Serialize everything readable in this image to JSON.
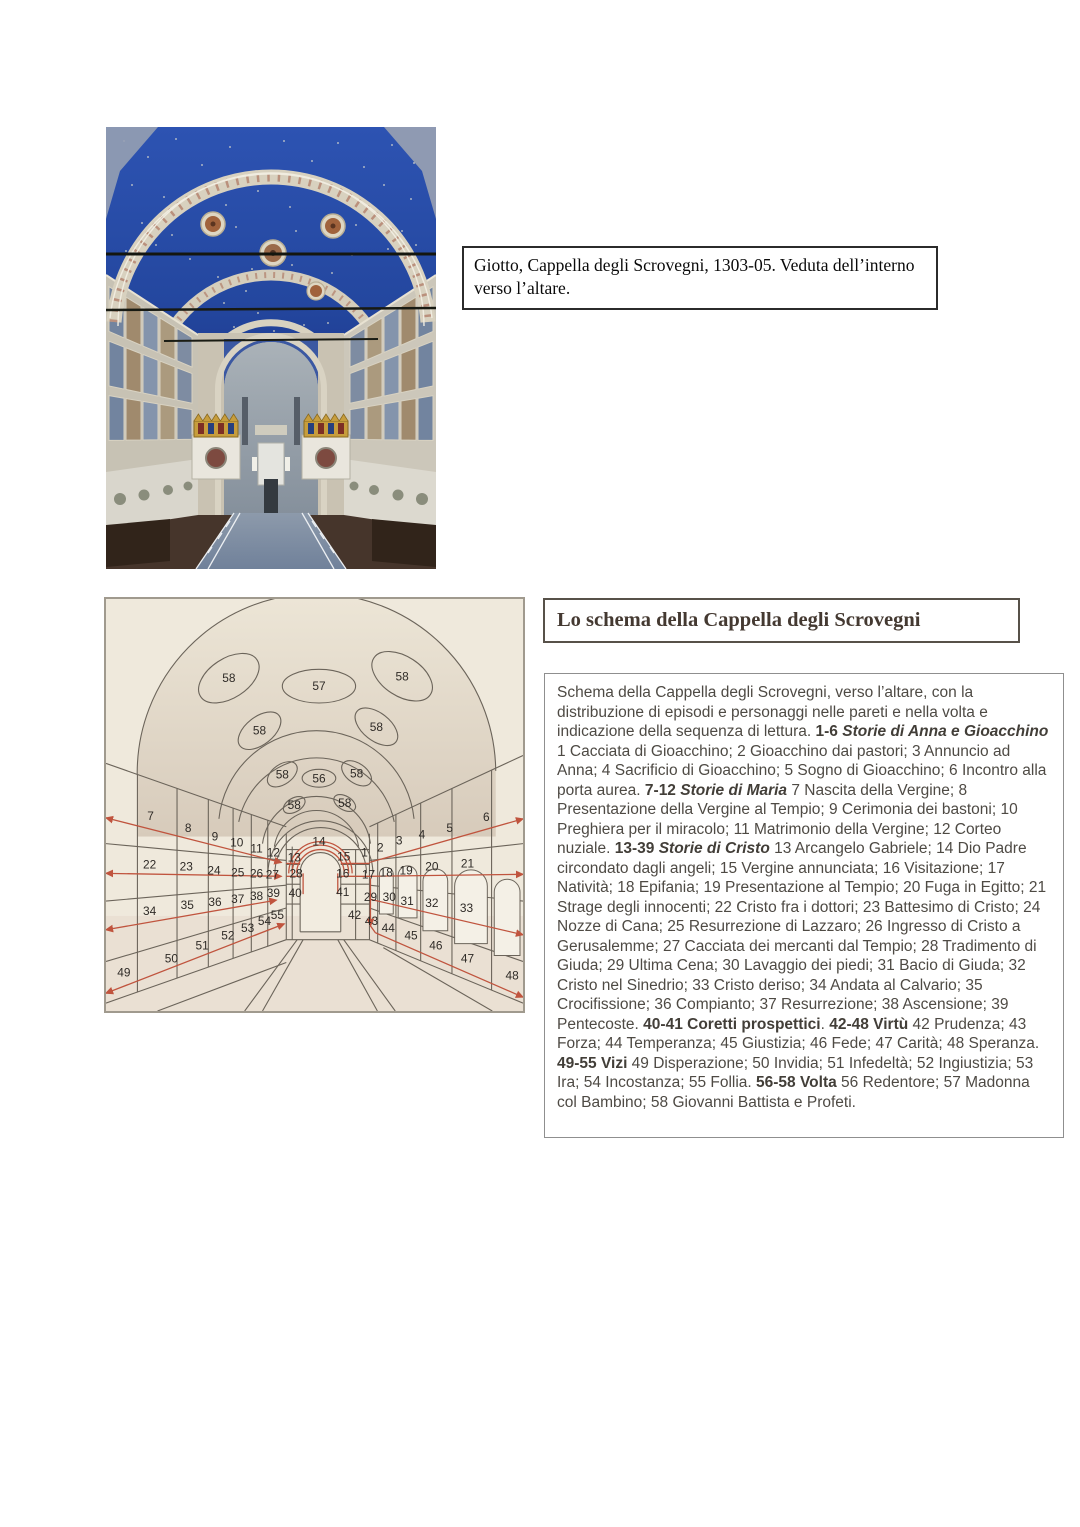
{
  "caption_box": {
    "text": "Giotto, Cappella degli Scrovegni, 1303-05. Veduta dell’interno verso l’altare."
  },
  "schema": {
    "title": "Lo schema della Cappella degli Scrovegni",
    "description": [
      {
        "t": "Schema della Cappella degli Scrovegni, verso l’altare, con la distribuzione di episodi e personaggi nelle pareti e nella volta e indicazione della sequenza di lettura. "
      },
      {
        "t": "1-6 ",
        "b": true
      },
      {
        "t": "Storie di Anna e Gioacchino",
        "b": true,
        "i": true
      },
      {
        "t": " 1 Cacciata di Gioacchino; 2 Gioacchino dai pastori; 3 Annuncio ad Anna; 4 Sacrificio di Gioacchino; 5 Sogno di Gioacchino; 6 Incontro alla porta aurea. "
      },
      {
        "t": "7-12 ",
        "b": true
      },
      {
        "t": "Storie di Maria",
        "b": true,
        "i": true
      },
      {
        "t": " 7 Nascita della Vergine; 8 Presentazione della Vergine al Tempio; 9 Cerimonia dei bastoni; 10 Preghiera per il miracolo; 11 Matrimonio della Vergine; 12 Corteo nuziale. "
      },
      {
        "t": "13-39 ",
        "b": true
      },
      {
        "t": "Storie di Cristo",
        "b": true,
        "i": true
      },
      {
        "t": " 13 Arcangelo Gabriele; 14 Dio Padre circondato dagli angeli; 15 Vergine annunciata; 16 Visitazione; 17 Natività; 18 Epifania; 19 Presentazione al Tempio; 20 Fuga in Egitto; 21 Strage degli innocenti; 22 Cristo fra i dottori; 23 Battesimo di Cristo; 24 Nozze di Cana; 25 Resurrezione di Lazzaro; 26 Ingresso di Cristo a Gerusalemme; 27 Cacciata dei mercanti dal Tempio; 28 Tradimento di Giuda; 29 Ultima Cena; 30 Lavaggio dei piedi; 31 Bacio di Giuda; 32 Cristo nel Sinedrio; 33 Cristo deriso; 34 Andata al Calvario; 35 Crocifissione; 36 Compianto; 37 Resurrezione; 38 Ascensione; 39 Pentecoste. "
      },
      {
        "t": "40-41 Coretti prospettici",
        "b": true
      },
      {
        "t": ". "
      },
      {
        "t": "42-48 Virtù",
        "b": true
      },
      {
        "t": " 42 Prudenza; 43 Forza; 44 Temperanza; 45 Giustizia; 46 Fede; 47 Carità; 48 Speranza. "
      },
      {
        "t": "49-55 Vizi",
        "b": true
      },
      {
        "t": " 49 Disperazione; 50 Invidia; 51 Infedeltà; 52 Ingiustizia; 53 Ira; 54 Incostanza; 55 Follia. "
      },
      {
        "t": "56-58 Volta",
        "b": true
      },
      {
        "t": " 56 Redentore; 57 Madonna col Bambino; 58 Giovanni Battista e Profeti."
      }
    ]
  },
  "diagram": {
    "vault_labels": [
      {
        "t": "58",
        "x": 124,
        "y": 80,
        "rx": 34,
        "ry": 20,
        "rot": -33
      },
      {
        "t": "57",
        "x": 215,
        "y": 88,
        "rx": 37,
        "ry": 17,
        "rot": 0
      },
      {
        "t": "58",
        "x": 299,
        "y": 78,
        "rx": 34,
        "ry": 20,
        "rot": 33
      },
      {
        "t": "58",
        "x": 155,
        "y": 133,
        "rx": 25,
        "ry": 14,
        "rot": -38
      },
      {
        "t": "58",
        "x": 273,
        "y": 129,
        "rx": 25,
        "ry": 14,
        "rot": 38
      },
      {
        "t": "58",
        "x": 178,
        "y": 177,
        "rx": 17,
        "ry": 10,
        "rot": -35
      },
      {
        "t": "56",
        "x": 215,
        "y": 181,
        "rx": 17,
        "ry": 9,
        "rot": 0
      },
      {
        "t": "58",
        "x": 253,
        "y": 176,
        "rx": 17,
        "ry": 10,
        "rot": 35
      },
      {
        "t": "58",
        "x": 190,
        "y": 208,
        "rx": 12,
        "ry": 7,
        "rot": -30
      },
      {
        "t": "58",
        "x": 241,
        "y": 206,
        "rx": 12,
        "ry": 7,
        "rot": 30
      }
    ],
    "wall_labels": [
      {
        "t": "7",
        "x": 45,
        "y": 219
      },
      {
        "t": "8",
        "x": 83,
        "y": 231
      },
      {
        "t": "9",
        "x": 110,
        "y": 240
      },
      {
        "t": "10",
        "x": 132,
        "y": 246
      },
      {
        "t": "11",
        "x": 152,
        "y": 252
      },
      {
        "t": "12",
        "x": 169,
        "y": 256
      },
      {
        "t": "22",
        "x": 44,
        "y": 268
      },
      {
        "t": "23",
        "x": 81,
        "y": 270
      },
      {
        "t": "24",
        "x": 109,
        "y": 274
      },
      {
        "t": "25",
        "x": 133,
        "y": 276
      },
      {
        "t": "26",
        "x": 152,
        "y": 277
      },
      {
        "t": "27",
        "x": 168,
        "y": 278
      },
      {
        "t": "34",
        "x": 44,
        "y": 315
      },
      {
        "t": "35",
        "x": 82,
        "y": 309
      },
      {
        "t": "36",
        "x": 110,
        "y": 306
      },
      {
        "t": "37",
        "x": 133,
        "y": 303
      },
      {
        "t": "38",
        "x": 152,
        "y": 300
      },
      {
        "t": "39",
        "x": 169,
        "y": 297
      },
      {
        "t": "49",
        "x": 18,
        "y": 377
      },
      {
        "t": "50",
        "x": 66,
        "y": 363
      },
      {
        "t": "51",
        "x": 97,
        "y": 350
      },
      {
        "t": "52",
        "x": 123,
        "y": 340
      },
      {
        "t": "53",
        "x": 143,
        "y": 332
      },
      {
        "t": "54",
        "x": 160,
        "y": 325
      },
      {
        "t": "55",
        "x": 173,
        "y": 319
      },
      {
        "t": "1",
        "x": 261,
        "y": 256
      },
      {
        "t": "2",
        "x": 277,
        "y": 251
      },
      {
        "t": "3",
        "x": 296,
        "y": 244
      },
      {
        "t": "4",
        "x": 319,
        "y": 238
      },
      {
        "t": "5",
        "x": 347,
        "y": 231
      },
      {
        "t": "6",
        "x": 384,
        "y": 220
      },
      {
        "t": "17",
        "x": 265,
        "y": 278
      },
      {
        "t": "18",
        "x": 283,
        "y": 276
      },
      {
        "t": "19",
        "x": 303,
        "y": 274
      },
      {
        "t": "20",
        "x": 329,
        "y": 270
      },
      {
        "t": "21",
        "x": 365,
        "y": 267
      },
      {
        "t": "29",
        "x": 267,
        "y": 301
      },
      {
        "t": "30",
        "x": 286,
        "y": 301
      },
      {
        "t": "31",
        "x": 304,
        "y": 305
      },
      {
        "t": "32",
        "x": 329,
        "y": 307
      },
      {
        "t": "33",
        "x": 364,
        "y": 312
      },
      {
        "t": "42",
        "x": 251,
        "y": 319
      },
      {
        "t": "43",
        "x": 268,
        "y": 325
      },
      {
        "t": "44",
        "x": 285,
        "y": 332
      },
      {
        "t": "45",
        "x": 308,
        "y": 340
      },
      {
        "t": "46",
        "x": 333,
        "y": 350
      },
      {
        "t": "47",
        "x": 365,
        "y": 363
      },
      {
        "t": "48",
        "x": 410,
        "y": 380
      },
      {
        "t": "13",
        "x": 190,
        "y": 261
      },
      {
        "t": "14",
        "x": 215,
        "y": 245
      },
      {
        "t": "15",
        "x": 240,
        "y": 260
      },
      {
        "t": "28",
        "x": 192,
        "y": 277
      },
      {
        "t": "16",
        "x": 239,
        "y": 277
      },
      {
        "t": "40",
        "x": 191,
        "y": 297
      },
      {
        "t": "41",
        "x": 239,
        "y": 296
      }
    ],
    "colors": {
      "line": "#6b645a",
      "sequence_red": "#c0543e",
      "number": "#2f2b27",
      "background": "#efe9dc"
    }
  },
  "colors": {
    "accent_red": "#c0543e",
    "title_text": "#443931",
    "body_text": "#4e4a44",
    "vault_blue": "#2a4da8"
  }
}
